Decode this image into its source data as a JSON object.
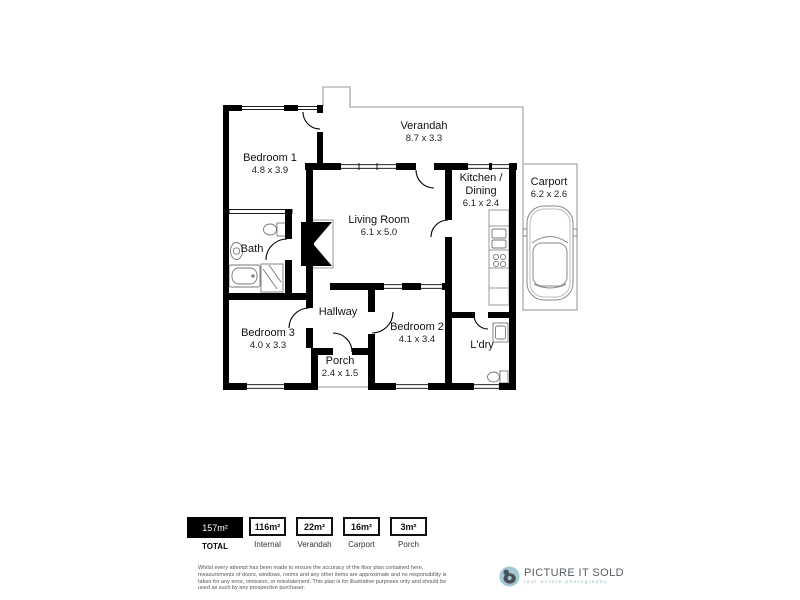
{
  "floorplan": {
    "rooms": [
      {
        "name": "Verandah",
        "dims": "8.7 x 3.3"
      },
      {
        "name": "Bedroom 1",
        "dims": "4.8 x 3.9"
      },
      {
        "name": "Kitchen / Dining",
        "dims": "6.1 x 2.4"
      },
      {
        "name": "Carport",
        "dims": "6.2 x 2.6"
      },
      {
        "name": "Living Room",
        "dims": "6.1 x 5.0"
      },
      {
        "name": "Bath",
        "dims": ""
      },
      {
        "name": "Hallway",
        "dims": ""
      },
      {
        "name": "Bedroom 3",
        "dims": "4.0 x 3.3"
      },
      {
        "name": "Bedroom 2",
        "dims": "4.1 x 3.4"
      },
      {
        "name": "L'dry",
        "dims": ""
      },
      {
        "name": "Porch",
        "dims": "2.4 x 1.5"
      }
    ]
  },
  "legend": {
    "items": [
      {
        "value": "157m²",
        "label": "TOTAL"
      },
      {
        "value": "116m²",
        "label": "Internal"
      },
      {
        "value": "22m²",
        "label": "Verandah"
      },
      {
        "value": "16m²",
        "label": "Carport"
      },
      {
        "value": "3m²",
        "label": "Porch"
      }
    ]
  },
  "footer": {
    "disclaimer": "Whilst every attempt has been made to ensure the accuracy of the floor plan contained here, measurements of doors, windows, rooms and any other items are approximate and no responsibility is taken for any error, omission, or misstatement. This plan is for illustrative purposes only and should be used as such by any prospective purchaser.",
    "brand": "PICTURE IT SOLD",
    "tagline": "real estate photography"
  },
  "colors": {
    "wall": "#000000",
    "thin_outline": "#9a9a9a",
    "brand_teal": "#a2c9d3",
    "brand_gray": "#565b60"
  }
}
